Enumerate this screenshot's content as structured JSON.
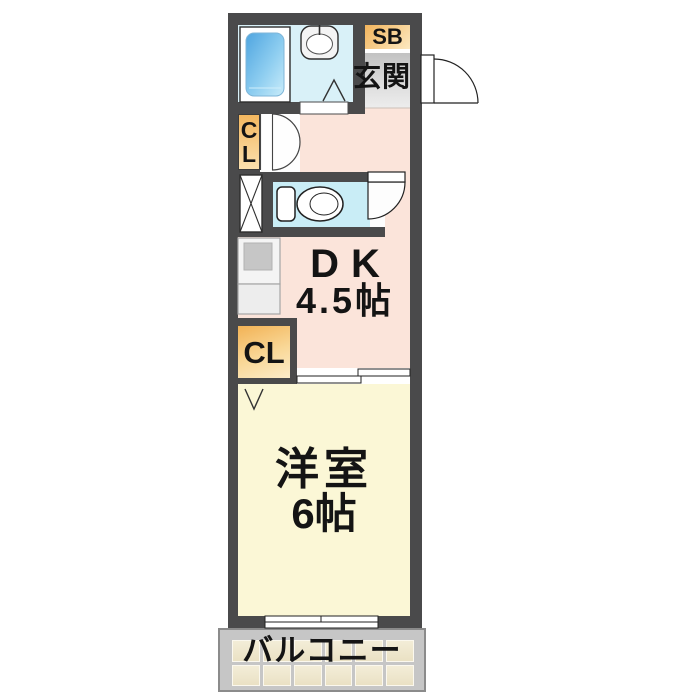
{
  "floorplan": {
    "unit": {
      "shoe_box_label": "SB",
      "entrance_label": "玄関",
      "upper_closet": {
        "line1": "C",
        "line2": "L"
      },
      "dining_kitchen": {
        "name": "DK",
        "size": "4.5帖"
      },
      "lower_closet_label": "CL",
      "western_room": {
        "name": "洋室",
        "size": "6帖"
      },
      "balcony_label": "バルコニー"
    },
    "colors": {
      "wall": "#4a4a4b",
      "bath_floor": "#d9f1f8",
      "bathtub_blue": "#55ade2",
      "toilet_floor": "#c9edf6",
      "storage_orange": "#f3b75f",
      "entrance_floor": "#cccccc",
      "dk_floor": "#fbe4da",
      "western_room_floor": "#fbf7d6",
      "balcony_frame": "#c6c6c6",
      "balcony_tile": "#efe8cf"
    }
  }
}
